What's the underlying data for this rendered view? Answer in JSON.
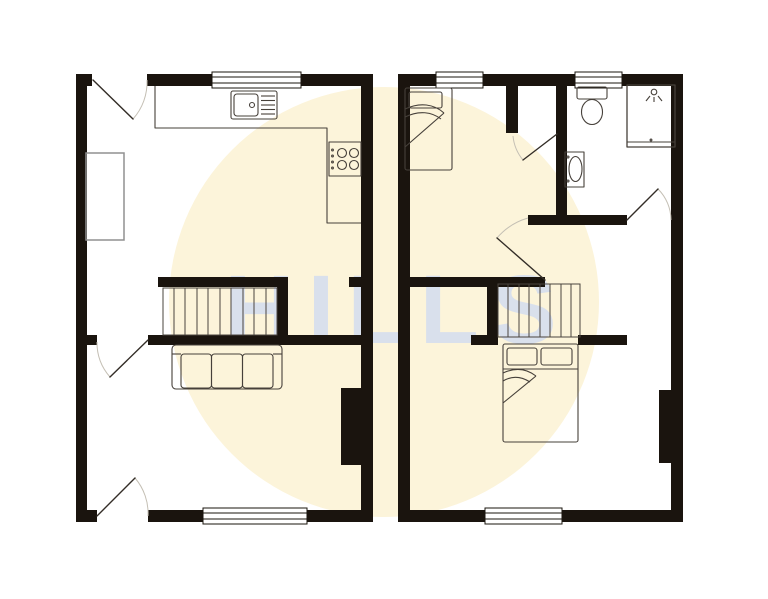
{
  "watermark": {
    "text": "HILLS"
  },
  "palette": {
    "background": "#ffffff",
    "highlight_circle": "#fcf4da",
    "watermark_text": "#d8dfee",
    "wall": "#1a140e",
    "fixture_line": "#46403a",
    "door_leaf_line": "#332d27",
    "door_swing_arc": "#c4bfb4",
    "stair_line": "#4a443e",
    "alcove_line": "#909090",
    "window_fill": "#ffffff"
  },
  "floorplan": {
    "type": "floor-plan",
    "units": [
      {
        "name": "left-unit",
        "windows": 2,
        "door_openings": 3,
        "fixtures": [
          "kitchen-sink",
          "four-ring-hob",
          "l-shaped-worktop",
          "wall-alcove-unit",
          "staircase",
          "three-seat-sofa",
          "chimney-breast"
        ]
      },
      {
        "name": "right-unit",
        "windows": 3,
        "door_openings": 3,
        "fixtures": [
          "single-bed",
          "toilet",
          "wash-basin",
          "shower-cubicle",
          "staircase",
          "double-bed",
          "chimney-breast"
        ]
      }
    ]
  }
}
